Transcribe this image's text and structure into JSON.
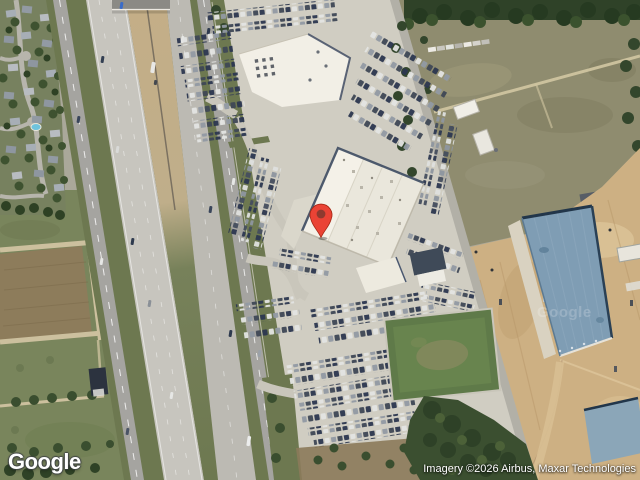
{
  "map": {
    "view_type": "satellite",
    "provider_logo": "Google",
    "imagery_watermark": "Google",
    "attribution": "Imagery ©2026 Airbus, Maxar Technologies",
    "marker": {
      "style": "red-teardrop-pin"
    }
  },
  "theme": {
    "pin_color": "#EA4335",
    "pin_inner_color": "#8E3A2F",
    "logo_color": "#FFFFFF",
    "attribution_color": "#FFFFFF"
  }
}
